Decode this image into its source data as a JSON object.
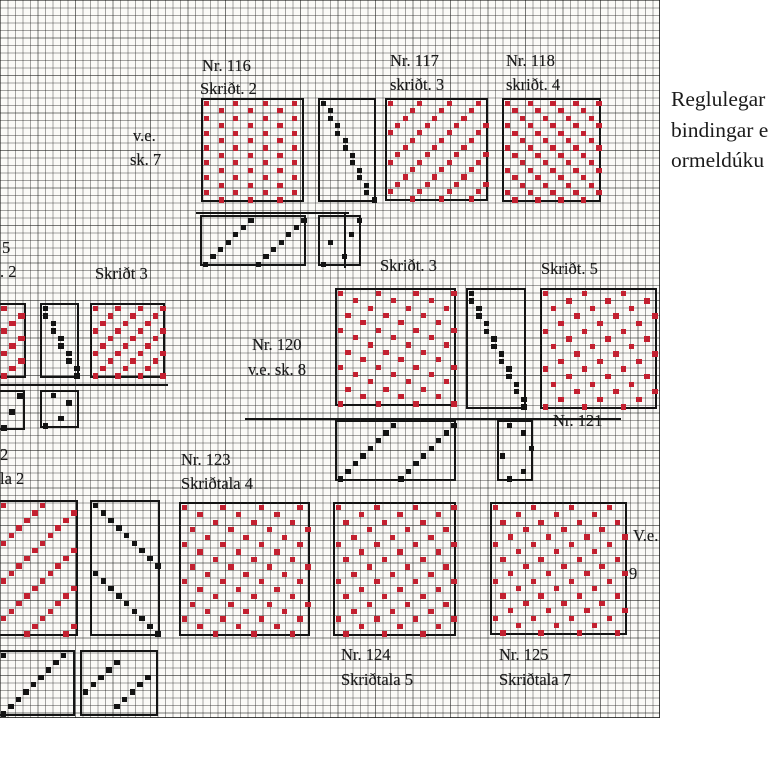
{
  "annotation": {
    "lines": [
      "Reglulegar",
      "bindingar e",
      "ormeldúku"
    ]
  },
  "chart_data": {
    "type": "heatmap",
    "title": "Weaving draft grid with numbered binding patterns (Icelandic)",
    "cell_px": 7.5,
    "grid": {
      "width_px": 659,
      "height_px": 717,
      "grid_on": true
    },
    "colors": {
      "motif_red": "#c32030",
      "motif_black": "#131313",
      "paper": "#fbfaf7",
      "border": "#141414"
    },
    "labels": [
      {
        "text": "Nr. 116",
        "x": 202,
        "y": 57
      },
      {
        "text": "Skriðt. 2",
        "x": 200,
        "y": 80
      },
      {
        "text": "Nr. 117",
        "x": 390,
        "y": 52
      },
      {
        "text": "skriðt. 3",
        "x": 390,
        "y": 76
      },
      {
        "text": "Nr. 118",
        "x": 506,
        "y": 52
      },
      {
        "text": "skriðt. 4",
        "x": 506,
        "y": 76
      },
      {
        "text": "v.e.",
        "x": 133,
        "y": 127
      },
      {
        "text": "sk. 7",
        "x": 130,
        "y": 151
      },
      {
        "text": "5",
        "x": 2,
        "y": 239
      },
      {
        "text": ". 2",
        "x": 0,
        "y": 263
      },
      {
        "text": "Skriðt 3",
        "x": 95,
        "y": 265
      },
      {
        "text": "Skriðt. 3",
        "x": 380,
        "y": 257
      },
      {
        "text": "Skriðt. 5",
        "x": 541,
        "y": 260
      },
      {
        "text": "Nr. 120",
        "x": 252,
        "y": 336
      },
      {
        "text": "v.e. sk. 8",
        "x": 248,
        "y": 361
      },
      {
        "text": "Nr. 121",
        "x": 553,
        "y": 412
      },
      {
        "text": "2",
        "x": 0,
        "y": 446
      },
      {
        "text": "la 2",
        "x": 0,
        "y": 470
      },
      {
        "text": "Nr. 123",
        "x": 181,
        "y": 451
      },
      {
        "text": "Skriðtala 4",
        "x": 181,
        "y": 475
      },
      {
        "text": "Nr. 124",
        "x": 341,
        "y": 646
      },
      {
        "text": "Skriðtala 5",
        "x": 341,
        "y": 671
      },
      {
        "text": "Nr. 125",
        "x": 499,
        "y": 646
      },
      {
        "text": "Skriðtala 7",
        "x": 499,
        "y": 671
      },
      {
        "text": "V.e.",
        "x": 633,
        "y": 527
      },
      {
        "text": "9",
        "x": 629,
        "y": 565
      }
    ],
    "separator_lines": [
      {
        "x": 196,
        "y": 212,
        "w": 153,
        "h": 2
      },
      {
        "x": 344,
        "y": 213,
        "w": 2,
        "h": 55
      },
      {
        "x": 0,
        "y": 384,
        "w": 168,
        "h": 2
      },
      {
        "x": 245,
        "y": 418,
        "w": 376,
        "h": 2
      }
    ],
    "blocks": [
      {
        "id": "nr116-motif",
        "color": "red",
        "x": 201,
        "y": 98,
        "w": 103,
        "h": 104,
        "cols": 14,
        "rows": 14,
        "rule": {
          "a": 1,
          "b": 2,
          "m": 4
        }
      },
      {
        "id": "nr116-treadling",
        "color": "black",
        "x": 318,
        "y": 98,
        "w": 58,
        "h": 104,
        "cols": 8,
        "rows": 14,
        "cells": [
          [
            0,
            0
          ],
          [
            1,
            1
          ],
          [
            2,
            1
          ],
          [
            3,
            2
          ],
          [
            4,
            2
          ],
          [
            5,
            3
          ],
          [
            6,
            3
          ],
          [
            7,
            4
          ],
          [
            8,
            4
          ],
          [
            9,
            5
          ],
          [
            10,
            5
          ],
          [
            11,
            6
          ],
          [
            12,
            6
          ],
          [
            13,
            7
          ]
        ]
      },
      {
        "id": "nr117-motif",
        "color": "red",
        "x": 385,
        "y": 98,
        "w": 103,
        "h": 103,
        "cols": 14,
        "rows": 14,
        "rule": {
          "a": 1,
          "b": 1,
          "m": 4
        }
      },
      {
        "id": "nr118-motif",
        "color": "red",
        "x": 502,
        "y": 98,
        "w": 99,
        "h": 104,
        "cols": 13,
        "rows": 14,
        "rule": {
          "a": 1,
          "b": 2,
          "m": 3
        }
      },
      {
        "id": "nr116-threading",
        "color": "black",
        "x": 200,
        "y": 215,
        "w": 106,
        "h": 51,
        "cols": 14,
        "rows": 7,
        "cells": [
          [
            6,
            0
          ],
          [
            5,
            1
          ],
          [
            4,
            2
          ],
          [
            3,
            3
          ],
          [
            2,
            4
          ],
          [
            1,
            5
          ],
          [
            0,
            6
          ],
          [
            6,
            7
          ],
          [
            5,
            8
          ],
          [
            4,
            9
          ],
          [
            3,
            10
          ],
          [
            2,
            11
          ],
          [
            1,
            12
          ],
          [
            0,
            13
          ]
        ]
      },
      {
        "id": "nr116-tieup",
        "color": "black",
        "x": 318,
        "y": 215,
        "w": 43,
        "h": 51,
        "cols": 6,
        "rows": 7,
        "cells": [
          [
            0,
            5
          ],
          [
            2,
            4
          ],
          [
            3,
            1
          ],
          [
            5,
            3
          ],
          [
            6,
            0
          ]
        ]
      },
      {
        "id": "nr119-motif-cut",
        "color": "red",
        "x": 0,
        "y": 303,
        "w": 26,
        "h": 75,
        "cols": 3,
        "rows": 10,
        "rule": {
          "a": 1,
          "b": 1,
          "m": 3
        },
        "cut": "left"
      },
      {
        "id": "nr119-treadling",
        "color": "black",
        "x": 40,
        "y": 303,
        "w": 39,
        "h": 75,
        "cols": 5,
        "rows": 10,
        "cells": [
          [
            0,
            0
          ],
          [
            1,
            0
          ],
          [
            2,
            1
          ],
          [
            3,
            1
          ],
          [
            4,
            2
          ],
          [
            5,
            2
          ],
          [
            6,
            3
          ],
          [
            7,
            3
          ],
          [
            8,
            4
          ],
          [
            9,
            4
          ]
        ]
      },
      {
        "id": "skridt3-motif",
        "color": "red",
        "x": 90,
        "y": 303,
        "w": 75,
        "h": 75,
        "cols": 10,
        "rows": 10,
        "rule": {
          "a": 1,
          "b": 1,
          "m": 3
        }
      },
      {
        "id": "nr119-threading",
        "color": "black",
        "x": 0,
        "y": 390,
        "w": 25,
        "h": 40,
        "cols": 3,
        "rows": 5,
        "cells": [
          [
            0,
            2
          ],
          [
            2,
            1
          ],
          [
            4,
            0
          ]
        ],
        "cut": "left"
      },
      {
        "id": "nr119-tieup",
        "color": "black",
        "x": 40,
        "y": 390,
        "w": 39,
        "h": 38,
        "cols": 5,
        "rows": 5,
        "cells": [
          [
            0,
            1
          ],
          [
            1,
            3
          ],
          [
            3,
            2
          ],
          [
            4,
            0
          ]
        ]
      },
      {
        "id": "nr120-motif",
        "color": "red",
        "x": 335,
        "y": 288,
        "w": 121,
        "h": 118,
        "cols": 16,
        "rows": 16,
        "rule": {
          "a": 2,
          "b": 1,
          "m": 5
        }
      },
      {
        "id": "nr120-treadling",
        "color": "black",
        "x": 466,
        "y": 288,
        "w": 60,
        "h": 121,
        "cols": 8,
        "rows": 16,
        "cells": [
          [
            0,
            0
          ],
          [
            1,
            0
          ],
          [
            2,
            1
          ],
          [
            3,
            1
          ],
          [
            4,
            2
          ],
          [
            5,
            2
          ],
          [
            6,
            3
          ],
          [
            7,
            3
          ],
          [
            8,
            4
          ],
          [
            9,
            4
          ],
          [
            10,
            5
          ],
          [
            11,
            5
          ],
          [
            12,
            6
          ],
          [
            13,
            6
          ],
          [
            14,
            7
          ],
          [
            15,
            7
          ]
        ]
      },
      {
        "id": "nr121-motif",
        "color": "red",
        "x": 540,
        "y": 288,
        "w": 117,
        "h": 121,
        "cols": 15,
        "rows": 16,
        "rule": {
          "a": 2,
          "b": 4,
          "m": 5
        }
      },
      {
        "id": "nr120-threading",
        "color": "black",
        "x": 335,
        "y": 420,
        "w": 121,
        "h": 61,
        "cols": 16,
        "rows": 8,
        "cells": [
          [
            7,
            0
          ],
          [
            6,
            1
          ],
          [
            5,
            2
          ],
          [
            4,
            3
          ],
          [
            3,
            4
          ],
          [
            2,
            5
          ],
          [
            1,
            6
          ],
          [
            0,
            7
          ],
          [
            7,
            8
          ],
          [
            6,
            9
          ],
          [
            5,
            10
          ],
          [
            4,
            11
          ],
          [
            3,
            12
          ],
          [
            2,
            13
          ],
          [
            1,
            14
          ],
          [
            0,
            15
          ]
        ]
      },
      {
        "id": "nr120-tieup",
        "color": "black",
        "x": 497,
        "y": 420,
        "w": 36,
        "h": 61,
        "cols": 5,
        "rows": 8,
        "cells": [
          [
            0,
            1
          ],
          [
            1,
            3
          ],
          [
            3,
            4
          ],
          [
            4,
            0
          ],
          [
            6,
            3
          ],
          [
            7,
            1
          ]
        ]
      },
      {
        "id": "nr122-motif-cut",
        "color": "red",
        "x": 0,
        "y": 500,
        "w": 78,
        "h": 136,
        "cols": 10,
        "rows": 18,
        "rule": {
          "a": 1,
          "b": 1,
          "m": 5
        },
        "cut": "left"
      },
      {
        "id": "nr122-treadling",
        "color": "black",
        "x": 90,
        "y": 500,
        "w": 70,
        "h": 136,
        "cols": 9,
        "rows": 18,
        "cells": [
          [
            0,
            0
          ],
          [
            1,
            1
          ],
          [
            2,
            2
          ],
          [
            3,
            3
          ],
          [
            4,
            4
          ],
          [
            5,
            5
          ],
          [
            6,
            6
          ],
          [
            7,
            7
          ],
          [
            8,
            8
          ],
          [
            9,
            0
          ],
          [
            10,
            1
          ],
          [
            11,
            2
          ],
          [
            12,
            3
          ],
          [
            13,
            4
          ],
          [
            14,
            5
          ],
          [
            15,
            6
          ],
          [
            16,
            7
          ],
          [
            17,
            8
          ]
        ]
      },
      {
        "id": "nr123-motif",
        "color": "red",
        "x": 179,
        "y": 502,
        "w": 131,
        "h": 134,
        "cols": 17,
        "rows": 18,
        "rule": {
          "a": 2,
          "b": 1,
          "m": 5
        }
      },
      {
        "id": "nr124-motif",
        "color": "red",
        "x": 333,
        "y": 502,
        "w": 123,
        "h": 134,
        "cols": 16,
        "rows": 18,
        "rule": {
          "a": 2,
          "b": 4,
          "m": 5
        }
      },
      {
        "id": "nr125-motif",
        "color": "red",
        "x": 490,
        "y": 502,
        "w": 137,
        "h": 133,
        "cols": 18,
        "rows": 18,
        "rule": {
          "a": 1,
          "b": 2,
          "m": 5
        }
      },
      {
        "id": "nr122-threading",
        "color": "black",
        "x": 0,
        "y": 650,
        "w": 75,
        "h": 66,
        "cols": 10,
        "rows": 9,
        "cells": [
          [
            0,
            0
          ],
          [
            0,
            8
          ],
          [
            1,
            7
          ],
          [
            2,
            6
          ],
          [
            3,
            5
          ],
          [
            4,
            4
          ],
          [
            5,
            3
          ],
          [
            6,
            2
          ],
          [
            7,
            1
          ],
          [
            8,
            0
          ]
        ],
        "cut": "left"
      },
      {
        "id": "nr122-tieup",
        "color": "black",
        "x": 80,
        "y": 650,
        "w": 78,
        "h": 66,
        "cols": 10,
        "rows": 9,
        "cells": [
          [
            1,
            4
          ],
          [
            2,
            3
          ],
          [
            3,
            2
          ],
          [
            4,
            1
          ],
          [
            5,
            0
          ],
          [
            3,
            8
          ],
          [
            4,
            7
          ],
          [
            5,
            6
          ],
          [
            6,
            5
          ],
          [
            7,
            4
          ]
        ]
      }
    ]
  }
}
